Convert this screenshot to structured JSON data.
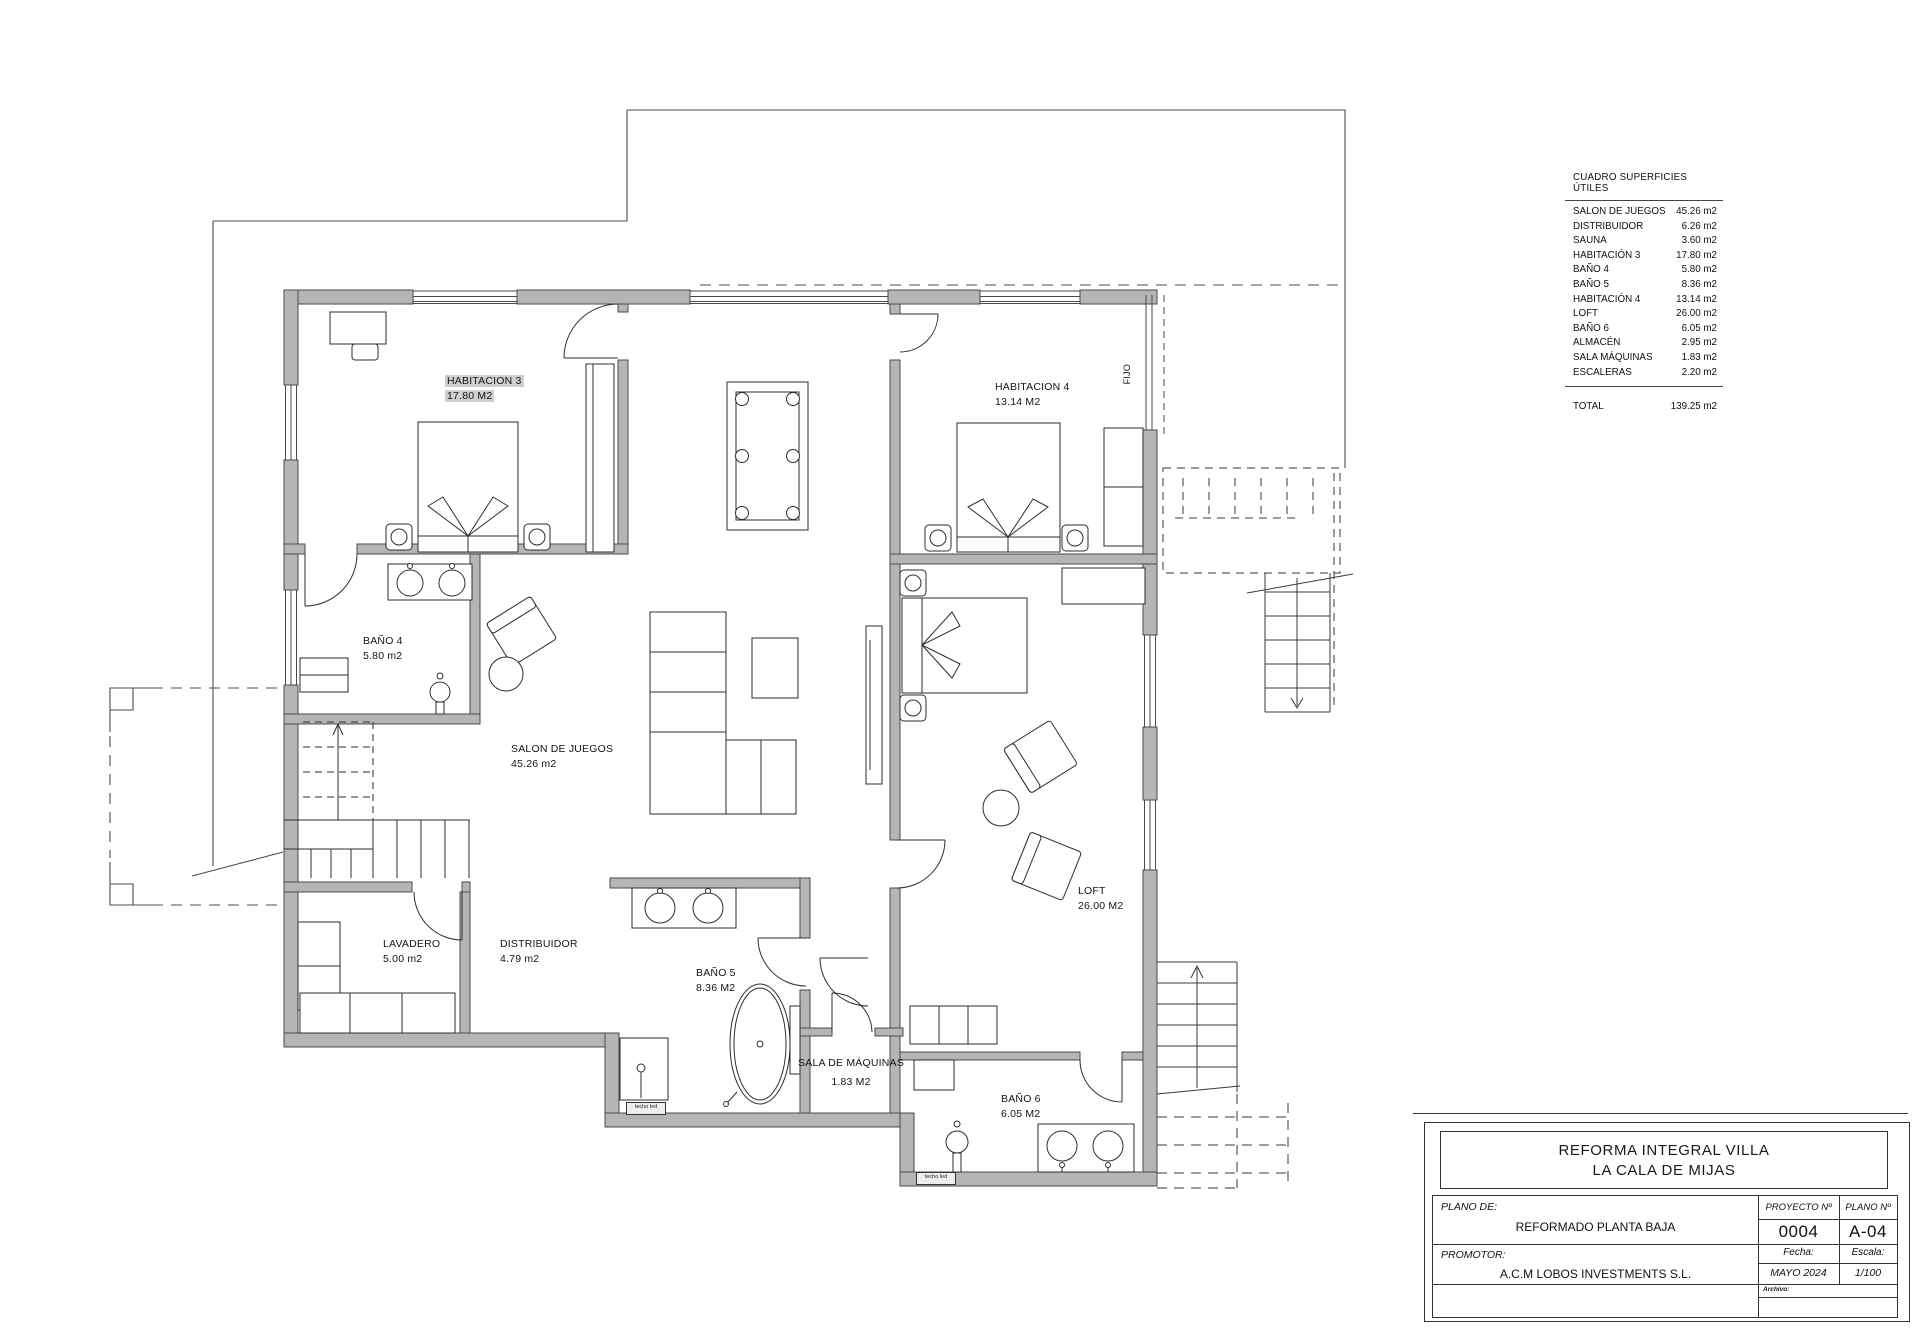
{
  "plan": {
    "rooms": {
      "habitacion3": {
        "name": "HABITACION 3",
        "area": "17.80 M2"
      },
      "habitacion4": {
        "name": "HABITACION 4",
        "area": "13.14 M2"
      },
      "bano4": {
        "name": "BAÑO 4",
        "area": "5.80 m2"
      },
      "salon": {
        "name": "SALON DE JUEGOS",
        "area": "45.26 m2"
      },
      "lavadero": {
        "name": "LAVADERO",
        "area": "5.00 m2"
      },
      "distribuidor": {
        "name": "DISTRIBUIDOR",
        "area": "4.79 m2"
      },
      "bano5": {
        "name": "BAÑO 5",
        "area": "8.36 M2"
      },
      "sala_maquinas": {
        "name": "SALA DE MÁQUINAS",
        "area": "1.83 M2"
      },
      "bano6": {
        "name": "BAÑO 6",
        "area": "6.05 M2"
      },
      "loft": {
        "name": "LOFT",
        "area": "26.00 M2"
      }
    },
    "annotations": {
      "fijo": "FIJO",
      "techo_led": "techo led"
    }
  },
  "surface_table": {
    "title": "CUADRO SUPERFICIES ÚTILES",
    "rows": [
      {
        "name": "SALON DE JUEGOS",
        "value": "45.26 m2"
      },
      {
        "name": "DISTRIBUIDOR",
        "value": "6.26 m2"
      },
      {
        "name": "SAUNA",
        "value": "3.60 m2"
      },
      {
        "name": "HABITACIÓN 3",
        "value": "17.80 m2"
      },
      {
        "name": "BAÑO 4",
        "value": "5.80 m2"
      },
      {
        "name": "BAÑO 5",
        "value": "8.36 m2"
      },
      {
        "name": "HABITACIÓN 4",
        "value": "13.14 m2"
      },
      {
        "name": "LOFT",
        "value": "26.00 m2"
      },
      {
        "name": "BAÑO 6",
        "value": "6.05 m2"
      },
      {
        "name": "ALMACÉN",
        "value": "2.95 m2"
      },
      {
        "name": "SALA MÁQUINAS",
        "value": "1.83 m2"
      },
      {
        "name": "ESCALERAS",
        "value": "2.20 m2"
      }
    ],
    "total_label": "TOTAL",
    "total_value": "139.25 m2"
  },
  "title_block": {
    "project_title_line1": "REFORMA INTEGRAL VILLA",
    "project_title_line2": "LA CALA DE MIJAS",
    "plano_de_label": "PLANO  DE:",
    "plano_de_value": "REFORMADO PLANTA BAJA",
    "promotor_label": "PROMOTOR:",
    "promotor_value": "A.C.M LOBOS INVESTMENTS S.L.",
    "proyecto_label": "PROYECTO  Nº",
    "proyecto_value": "0004",
    "plano_num_label": "PLANO  Nº",
    "plano_num_value": "A-04",
    "fecha_label": "Fecha:",
    "fecha_value": "MAYO  2024",
    "escala_label": "Escala:",
    "escala_value": "1/100",
    "archivo_label": "Archivo:"
  }
}
